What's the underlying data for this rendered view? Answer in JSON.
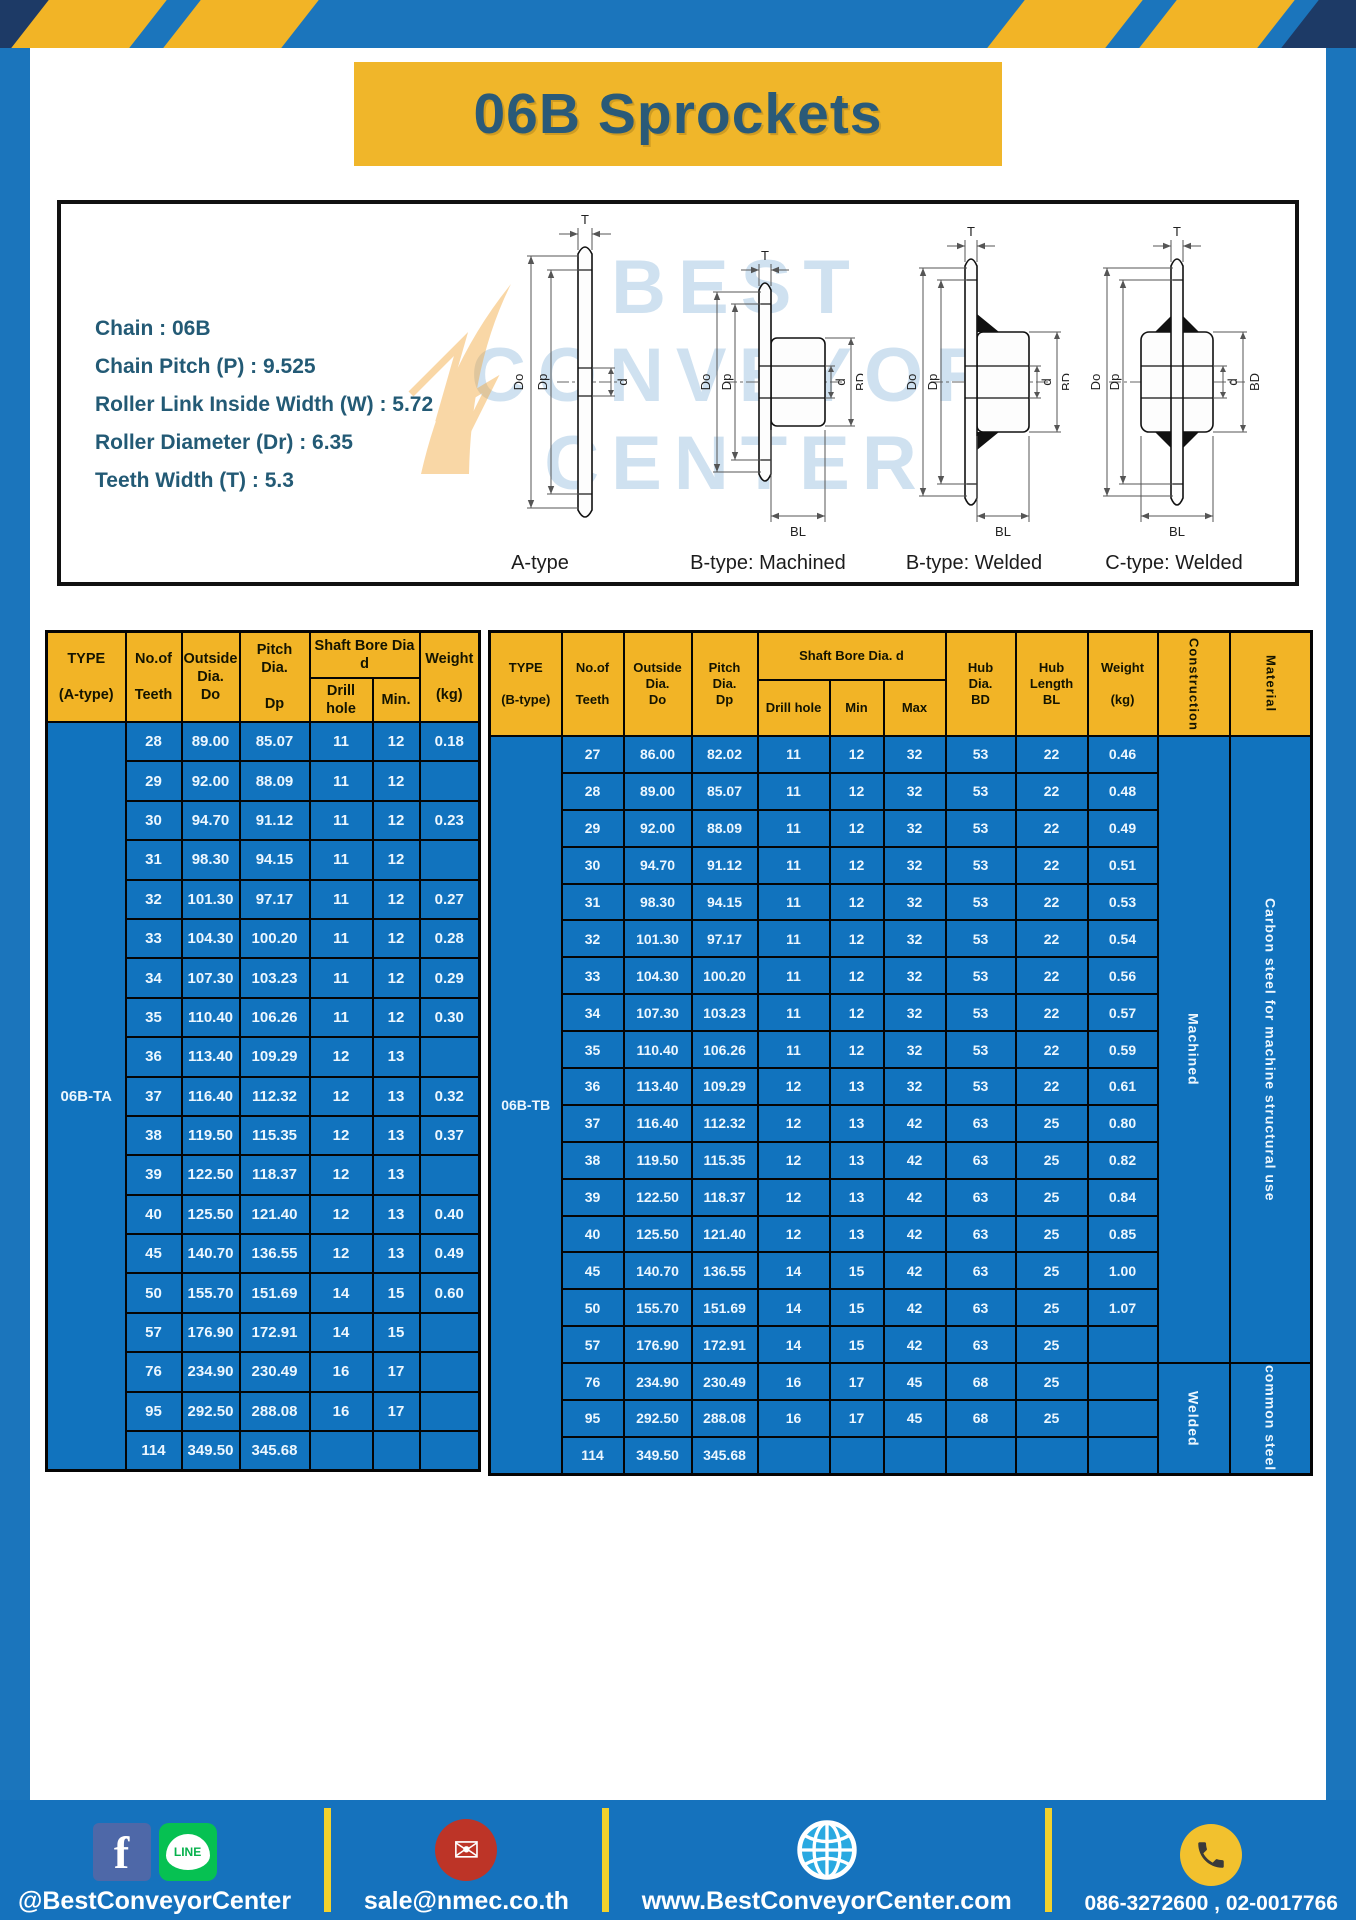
{
  "title": "06B Sprockets",
  "specs": {
    "lines": [
      "Chain  : 06B",
      "Chain Pitch (P)  :  9.525",
      "Roller Link Inside Width (W)  :  5.72",
      "Roller Diameter (Dr)  : 6.35",
      "Teeth Width (T)  :  5.3"
    ]
  },
  "watermark": {
    "line1": "BEST",
    "line2": "CONVEYOR",
    "line3": "CENTER"
  },
  "diagram_captions": [
    "A-type",
    "B-type: Machined",
    "B-type: Welded",
    "C-type: Welded"
  ],
  "dim": {
    "t": "T",
    "do": "Do",
    "dp": "Dp",
    "d": "d",
    "bd": "BD",
    "bl": "BL"
  },
  "table_a": {
    "headers": {
      "type": "TYPE\n\n(A-type)",
      "teeth": "No.of\n\nTeeth",
      "outside": "Outside\nDia.\nDo",
      "pitch": "Pitch Dia.\n\nDp",
      "shaft_group": "Shaft Bore Dia d",
      "drill": "Drill hole",
      "min": "Min.",
      "weight": "Weight\n\n(kg)"
    },
    "type_label": "06B-TA",
    "rows": [
      [
        "28",
        "89.00",
        "85.07",
        "11",
        "12",
        "0.18"
      ],
      [
        "29",
        "92.00",
        "88.09",
        "11",
        "12",
        ""
      ],
      [
        "30",
        "94.70",
        "91.12",
        "11",
        "12",
        "0.23"
      ],
      [
        "31",
        "98.30",
        "94.15",
        "11",
        "12",
        ""
      ],
      [
        "32",
        "101.30",
        "97.17",
        "11",
        "12",
        "0.27"
      ],
      [
        "33",
        "104.30",
        "100.20",
        "11",
        "12",
        "0.28"
      ],
      [
        "34",
        "107.30",
        "103.23",
        "11",
        "12",
        "0.29"
      ],
      [
        "35",
        "110.40",
        "106.26",
        "11",
        "12",
        "0.30"
      ],
      [
        "36",
        "113.40",
        "109.29",
        "12",
        "13",
        ""
      ],
      [
        "37",
        "116.40",
        "112.32",
        "12",
        "13",
        "0.32"
      ],
      [
        "38",
        "119.50",
        "115.35",
        "12",
        "13",
        "0.37"
      ],
      [
        "39",
        "122.50",
        "118.37",
        "12",
        "13",
        ""
      ],
      [
        "40",
        "125.50",
        "121.40",
        "12",
        "13",
        "0.40"
      ],
      [
        "45",
        "140.70",
        "136.55",
        "12",
        "13",
        "0.49"
      ],
      [
        "50",
        "155.70",
        "151.69",
        "14",
        "15",
        "0.60"
      ],
      [
        "57",
        "176.90",
        "172.91",
        "14",
        "15",
        ""
      ],
      [
        "76",
        "234.90",
        "230.49",
        "16",
        "17",
        ""
      ],
      [
        "95",
        "292.50",
        "288.08",
        "16",
        "17",
        ""
      ],
      [
        "114",
        "349.50",
        "345.68",
        "",
        "",
        ""
      ]
    ]
  },
  "table_b": {
    "headers": {
      "type": "TYPE\n\n(B-type)",
      "teeth": "No.of\n\nTeeth",
      "outside": "Outside\nDia.\nDo",
      "pitch": "Pitch\nDia.\nDp",
      "shaft_group": "Shaft Bore Dia. d",
      "drill": "Drill hole",
      "min": "Min",
      "max": "Max",
      "hub_dia": "Hub\nDia.\nBD",
      "hub_len": "Hub\nLength\nBL",
      "weight": "Weight\n\n(kg)",
      "construction": "Construction",
      "material": "Material"
    },
    "type_label": "06B-TB",
    "sections": [
      {
        "start": 0,
        "span": 17,
        "construction": "Machined",
        "material": "Carbon steel for machine structural use"
      },
      {
        "start": 17,
        "span": 3,
        "construction": "Welded",
        "material": "common steel"
      }
    ],
    "rows": [
      [
        "27",
        "86.00",
        "82.02",
        "11",
        "12",
        "32",
        "53",
        "22",
        "0.46"
      ],
      [
        "28",
        "89.00",
        "85.07",
        "11",
        "12",
        "32",
        "53",
        "22",
        "0.48"
      ],
      [
        "29",
        "92.00",
        "88.09",
        "11",
        "12",
        "32",
        "53",
        "22",
        "0.49"
      ],
      [
        "30",
        "94.70",
        "91.12",
        "11",
        "12",
        "32",
        "53",
        "22",
        "0.51"
      ],
      [
        "31",
        "98.30",
        "94.15",
        "11",
        "12",
        "32",
        "53",
        "22",
        "0.53"
      ],
      [
        "32",
        "101.30",
        "97.17",
        "11",
        "12",
        "32",
        "53",
        "22",
        "0.54"
      ],
      [
        "33",
        "104.30",
        "100.20",
        "11",
        "12",
        "32",
        "53",
        "22",
        "0.56"
      ],
      [
        "34",
        "107.30",
        "103.23",
        "11",
        "12",
        "32",
        "53",
        "22",
        "0.57"
      ],
      [
        "35",
        "110.40",
        "106.26",
        "11",
        "12",
        "32",
        "53",
        "22",
        "0.59"
      ],
      [
        "36",
        "113.40",
        "109.29",
        "12",
        "13",
        "32",
        "53",
        "22",
        "0.61"
      ],
      [
        "37",
        "116.40",
        "112.32",
        "12",
        "13",
        "42",
        "63",
        "25",
        "0.80"
      ],
      [
        "38",
        "119.50",
        "115.35",
        "12",
        "13",
        "42",
        "63",
        "25",
        "0.82"
      ],
      [
        "39",
        "122.50",
        "118.37",
        "12",
        "13",
        "42",
        "63",
        "25",
        "0.84"
      ],
      [
        "40",
        "125.50",
        "121.40",
        "12",
        "13",
        "42",
        "63",
        "25",
        "0.85"
      ],
      [
        "45",
        "140.70",
        "136.55",
        "14",
        "15",
        "42",
        "63",
        "25",
        "1.00"
      ],
      [
        "50",
        "155.70",
        "151.69",
        "14",
        "15",
        "42",
        "63",
        "25",
        "1.07"
      ],
      [
        "57",
        "176.90",
        "172.91",
        "14",
        "15",
        "42",
        "63",
        "25",
        ""
      ],
      [
        "76",
        "234.90",
        "230.49",
        "16",
        "17",
        "45",
        "68",
        "25",
        ""
      ],
      [
        "95",
        "292.50",
        "288.08",
        "16",
        "17",
        "45",
        "68",
        "25",
        ""
      ],
      [
        "114",
        "349.50",
        "345.68",
        "",
        "",
        "",
        "",
        "",
        ""
      ]
    ]
  },
  "footer": {
    "items": [
      {
        "label": "@BestConveyorCenter"
      },
      {
        "label": "sale@nmec.co.th"
      },
      {
        "label": "www.BestConveyorCenter.com"
      },
      {
        "label": "086-3272600 , 02-0017766"
      }
    ],
    "line_icon_text": "LINE",
    "fb_letter": "f",
    "mail_glyph": "✉"
  },
  "colors": {
    "frame_blue": "#1b75bc",
    "stripe_yellow": "#f2b426",
    "navy": "#1d3a66",
    "header_yellow": "#f2b426",
    "cell_blue": "#1173be",
    "title_text": "#2a5a78",
    "separator_yellow": "#f2d12c"
  }
}
